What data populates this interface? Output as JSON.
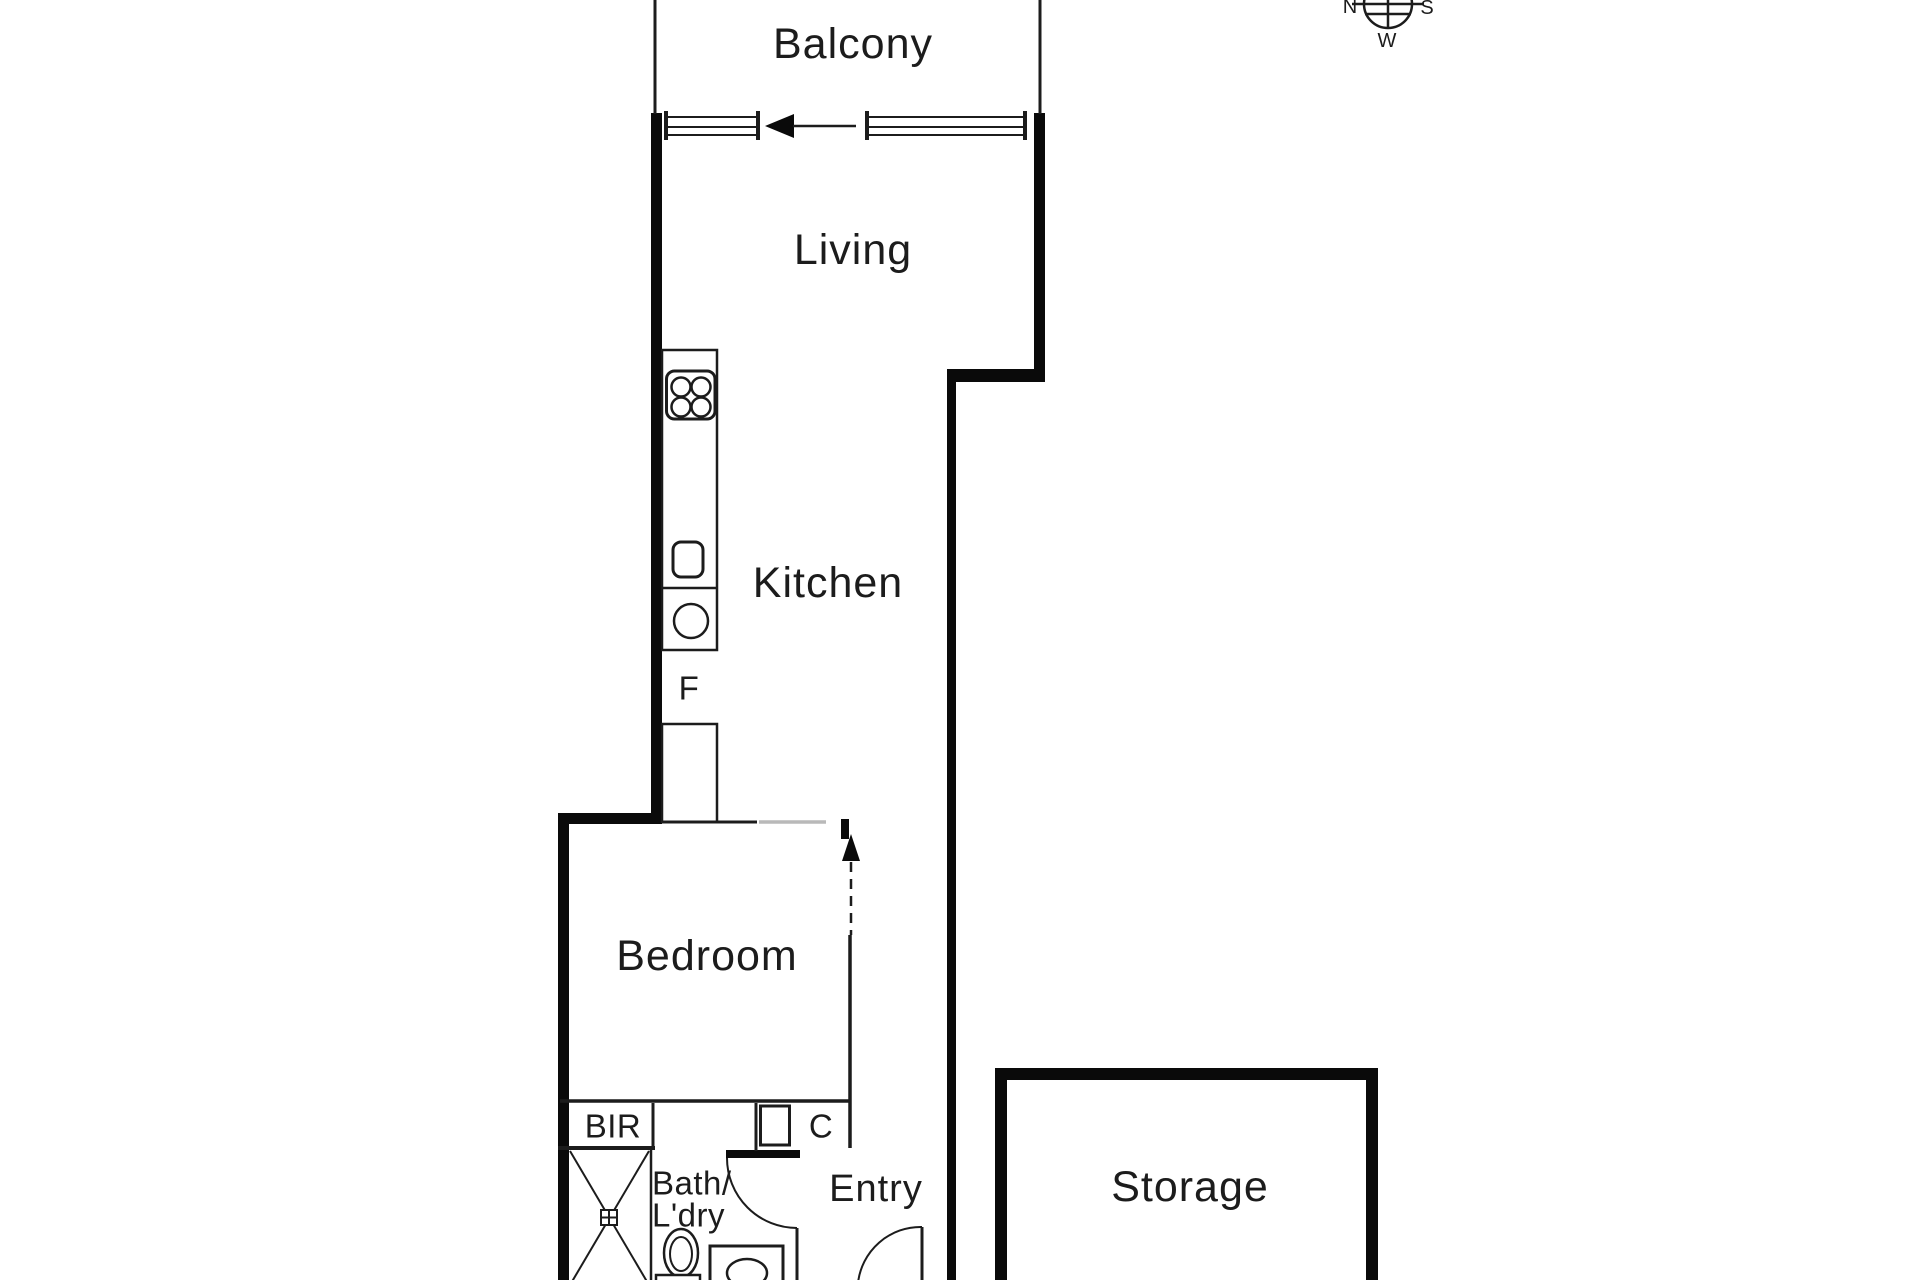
{
  "floorplan": {
    "labels": {
      "balcony": "Balcony",
      "living": "Living",
      "kitchen": "Kitchen",
      "fridge": "F",
      "bedroom": "Bedroom",
      "bir": "BIR",
      "cupboard": "C",
      "bath_line1": "Bath/",
      "bath_line2": "L'dry",
      "entry": "Entry",
      "storage": "Storage"
    },
    "compass": {
      "n": "N",
      "s": "S",
      "w": "W"
    },
    "colors": {
      "wall": "#0a0a0a",
      "line": "#1c1c1c",
      "opening": "#b9b9b9",
      "background": "#ffffff"
    }
  }
}
